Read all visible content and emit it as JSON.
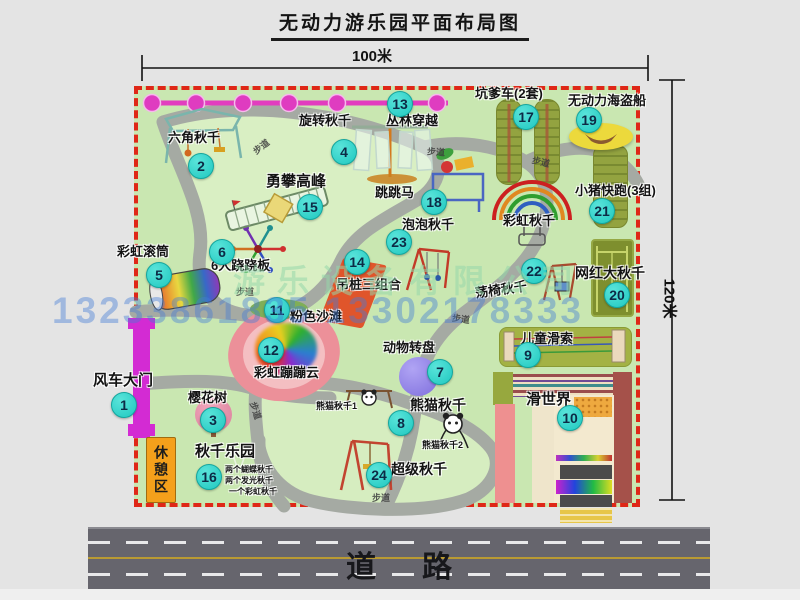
{
  "title": "无动力游乐园平面布局图",
  "dim_width": "100米",
  "dim_height": "120米",
  "road_label": "道路",
  "path_label": "步道",
  "rest_area": "休憩区",
  "rainbow_swing_label": "彩虹秋千",
  "panda_swing_1": "熊猫秋千1",
  "panda_swing_2": "熊猫秋千2",
  "swing_notes": [
    "两个蝴蝶秋千",
    "两个发光秋千",
    "一个彩虹秋千"
  ],
  "watermark": {
    "company": "游乐设备有限公司",
    "phone": "13233861835 13302178333"
  },
  "colors": {
    "map_green": "#c9e7b1",
    "border_red": "#df2717",
    "badge_teal": "#1fc8c0",
    "chain_magenta": "#e23dbf",
    "gate_magenta": "#d32bd3",
    "rest_orange": "#f4a01b"
  },
  "facilities": [
    {
      "num": 1,
      "label": "风车大门"
    },
    {
      "num": 2,
      "label": "六角秋千"
    },
    {
      "num": 3,
      "label": "樱花树"
    },
    {
      "num": 4,
      "label": "旋转秋千"
    },
    {
      "num": 5,
      "label": "彩虹滚筒"
    },
    {
      "num": 6,
      "label": "6人跷跷板"
    },
    {
      "num": 7,
      "label": "动物转盘"
    },
    {
      "num": 8,
      "label": "熊猫秋千"
    },
    {
      "num": 9,
      "label": "儿童滑索"
    },
    {
      "num": 10,
      "label": "滑世界"
    },
    {
      "num": 11,
      "label": "粉色沙滩"
    },
    {
      "num": 12,
      "label": "彩虹蹦蹦云"
    },
    {
      "num": 13,
      "label": "丛林穿越"
    },
    {
      "num": 14,
      "label": "吊桩三组合"
    },
    {
      "num": 15,
      "label": "勇攀高峰"
    },
    {
      "num": 16,
      "label": "秋千乐园"
    },
    {
      "num": 17,
      "label": "坑爹车(2套)"
    },
    {
      "num": 18,
      "label": "跳跳马"
    },
    {
      "num": 19,
      "label": "无动力海盗船"
    },
    {
      "num": 20,
      "label": "网红大秋千"
    },
    {
      "num": 21,
      "label": "小猪快跑(3组)"
    },
    {
      "num": 22,
      "label": "荡椅秋千"
    },
    {
      "num": 23,
      "label": "泡泡秋千"
    },
    {
      "num": 24,
      "label": "超级秋千"
    }
  ]
}
